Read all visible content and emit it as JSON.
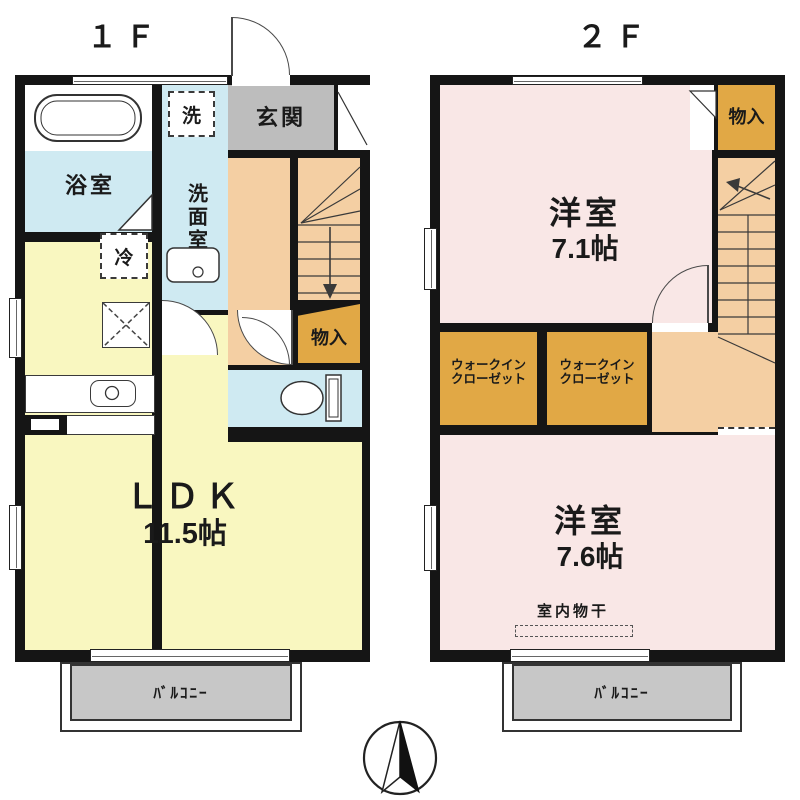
{
  "titles": {
    "floor1": "１Ｆ",
    "floor2": "２Ｆ"
  },
  "floor1": {
    "bath": "浴室",
    "laundry": "洗",
    "washroom": "洗面室",
    "entrance": "玄関",
    "fridge": "冷",
    "closet": "物入",
    "ldk_name": "ＬＤＫ",
    "ldk_size": "11.5帖",
    "balcony": "ﾊﾞﾙｺﾆｰ"
  },
  "floor2": {
    "bedroom1_name": "洋室",
    "bedroom1_size": "7.1帖",
    "closet": "物入",
    "wic1_line1": "ウォークイン",
    "wic1_line2": "クローゼット",
    "wic2_line1": "ウォークイン",
    "wic2_line2": "クローゼット",
    "bedroom2_name": "洋室",
    "bedroom2_size": "7.6帖",
    "drying": "室内物干",
    "balcony": "ﾊﾞﾙｺﾆｰ"
  },
  "colors": {
    "wall": "#151515",
    "water": "#cfeaf2",
    "ldk": "#f9f7c0",
    "bedroom": "#f9e7e6",
    "hall": "#f4cfa3",
    "closet": "#e1a845",
    "entrance": "#bdbdbd",
    "balcony": "#c7c7c7"
  }
}
